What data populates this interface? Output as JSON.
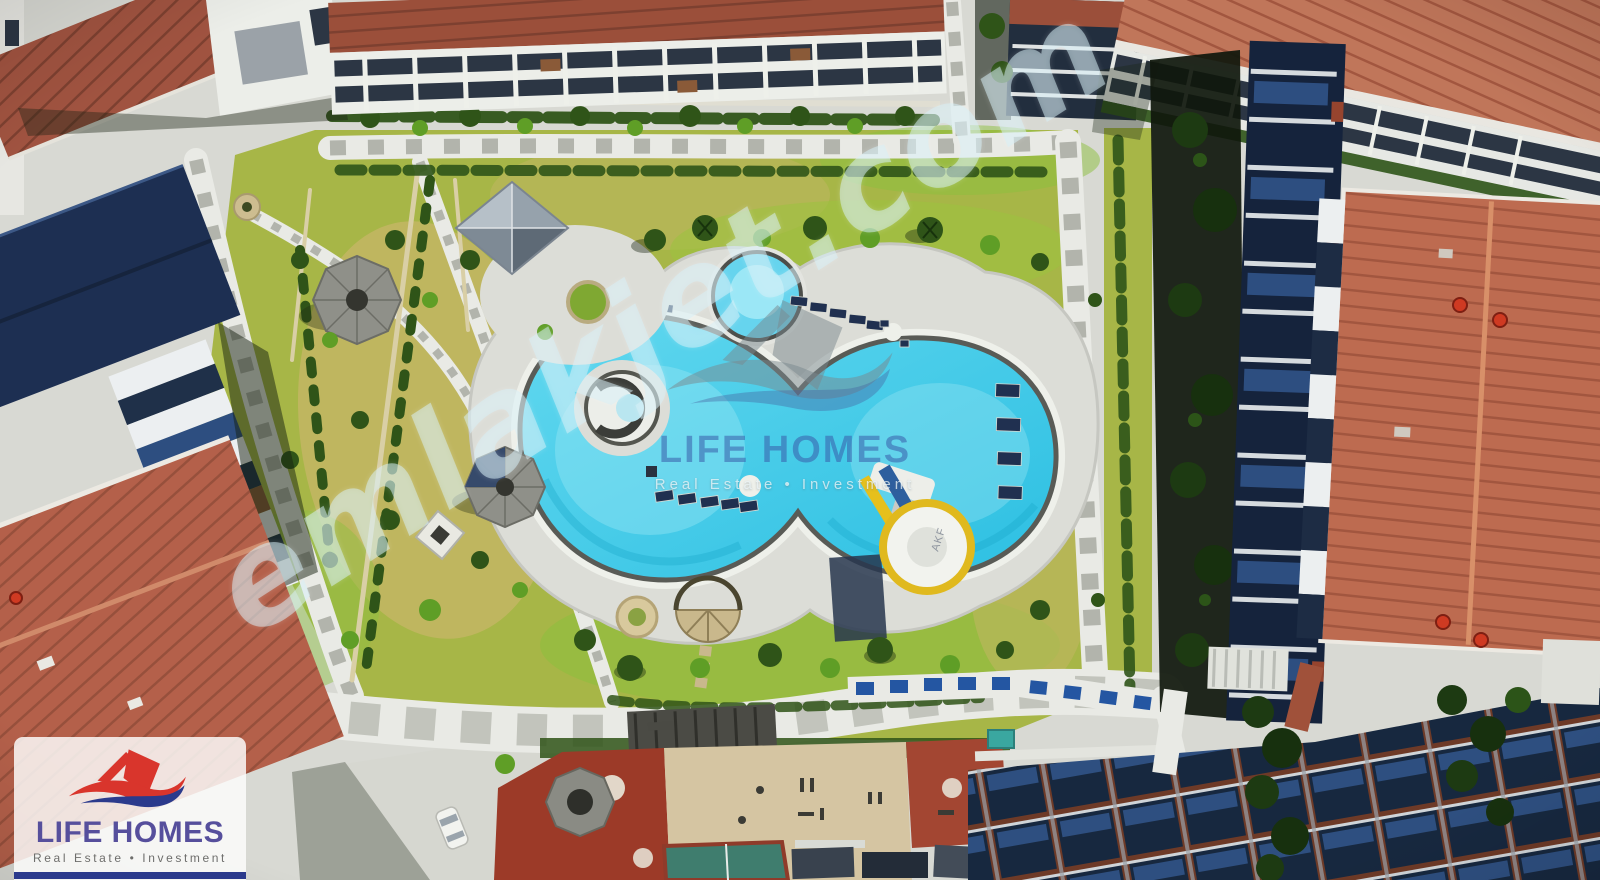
{
  "watermarks": {
    "diagonal": {
      "text": "emlakjet.com"
    },
    "center": {
      "brand": "LIFE HOMES",
      "tagline": "Real Estate • Investment"
    },
    "corner": {
      "brand": "LIFE HOMES",
      "tagline": "Real Estate • Investment"
    },
    "slide_brand": "AKF"
  },
  "colors": {
    "concrete": "#d8d9d3",
    "deck": "#dcddd7",
    "pathLight": "#e9eae5",
    "paver": "#b2b4ac",
    "paverBig": "#c2c4bc",
    "grass": "#a7b647",
    "grassBright": "#8cbf3d",
    "grassDry": "#c6b665",
    "shrub": "#2f5418",
    "shrubBright": "#5f9e26",
    "water": "#3cc9e8",
    "waterLight": "#93e4f3",
    "poolRim": "#595b56",
    "roofRed": "#bd6b50",
    "roofRedSeam": "#a2563f",
    "roofOxide": "#9b4f3a",
    "navyRoof": "#1b2b47",
    "navyLight": "#2e4f80",
    "facadeWhite": "#eceee9",
    "glassDark": "#2c3644",
    "shadowDark": "#11190d",
    "playRed": "#9c3a28",
    "sand": "#d5c5a2",
    "teal": "#3f7d6e",
    "logoPurple": "#564f9c",
    "logoRed": "#d9352c",
    "logoNavy": "#2b3a8c",
    "logoGray": "#6e6e6c",
    "wmCyan": "rgba(215,240,247,0.52)",
    "wmBlue": "rgba(56,92,170,0.55)",
    "wmGray": "rgba(122,136,142,0.5)",
    "wmTag": "rgba(238,246,248,0.75)"
  }
}
